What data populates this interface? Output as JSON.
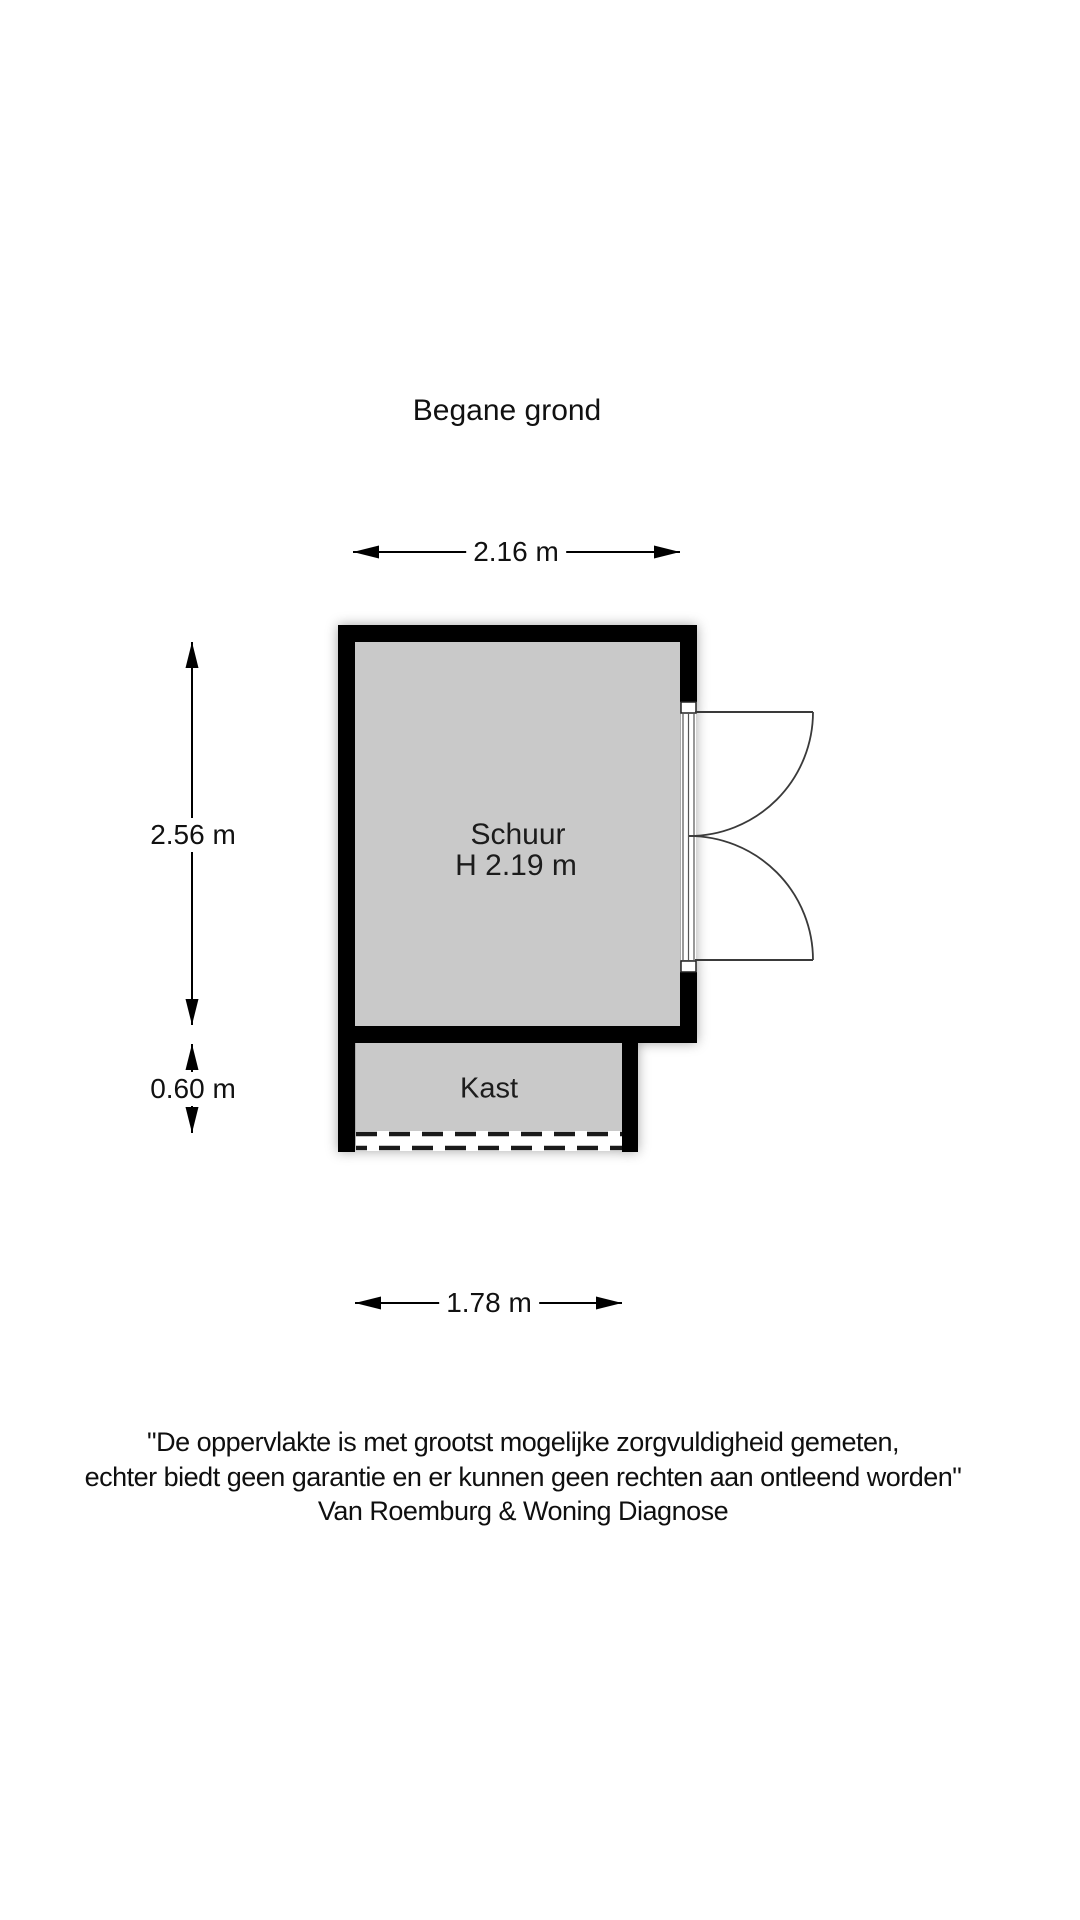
{
  "title": "Begane grond",
  "plan": {
    "rooms": [
      {
        "name": "Schuur",
        "ceiling_height": "H 2.19 m"
      },
      {
        "name": "Kast"
      }
    ],
    "dimensions": {
      "top": "2.16 m",
      "left_upper": "2.56 m",
      "left_lower": "0.60 m",
      "bottom": "1.78 m"
    }
  },
  "disclaimer": {
    "line1": "\"De oppervlakte is met grootst mogelijke zorgvuldigheid gemeten,",
    "line2": "echter biedt geen garantie en er kunnen geen rechten aan ontleend worden\"",
    "line3": "Van Roemburg & Woning Diagnose"
  },
  "colors": {
    "wall": "#000000",
    "floor": "#c9c9c9",
    "background": "#ffffff",
    "line": "#1a1a1a"
  }
}
